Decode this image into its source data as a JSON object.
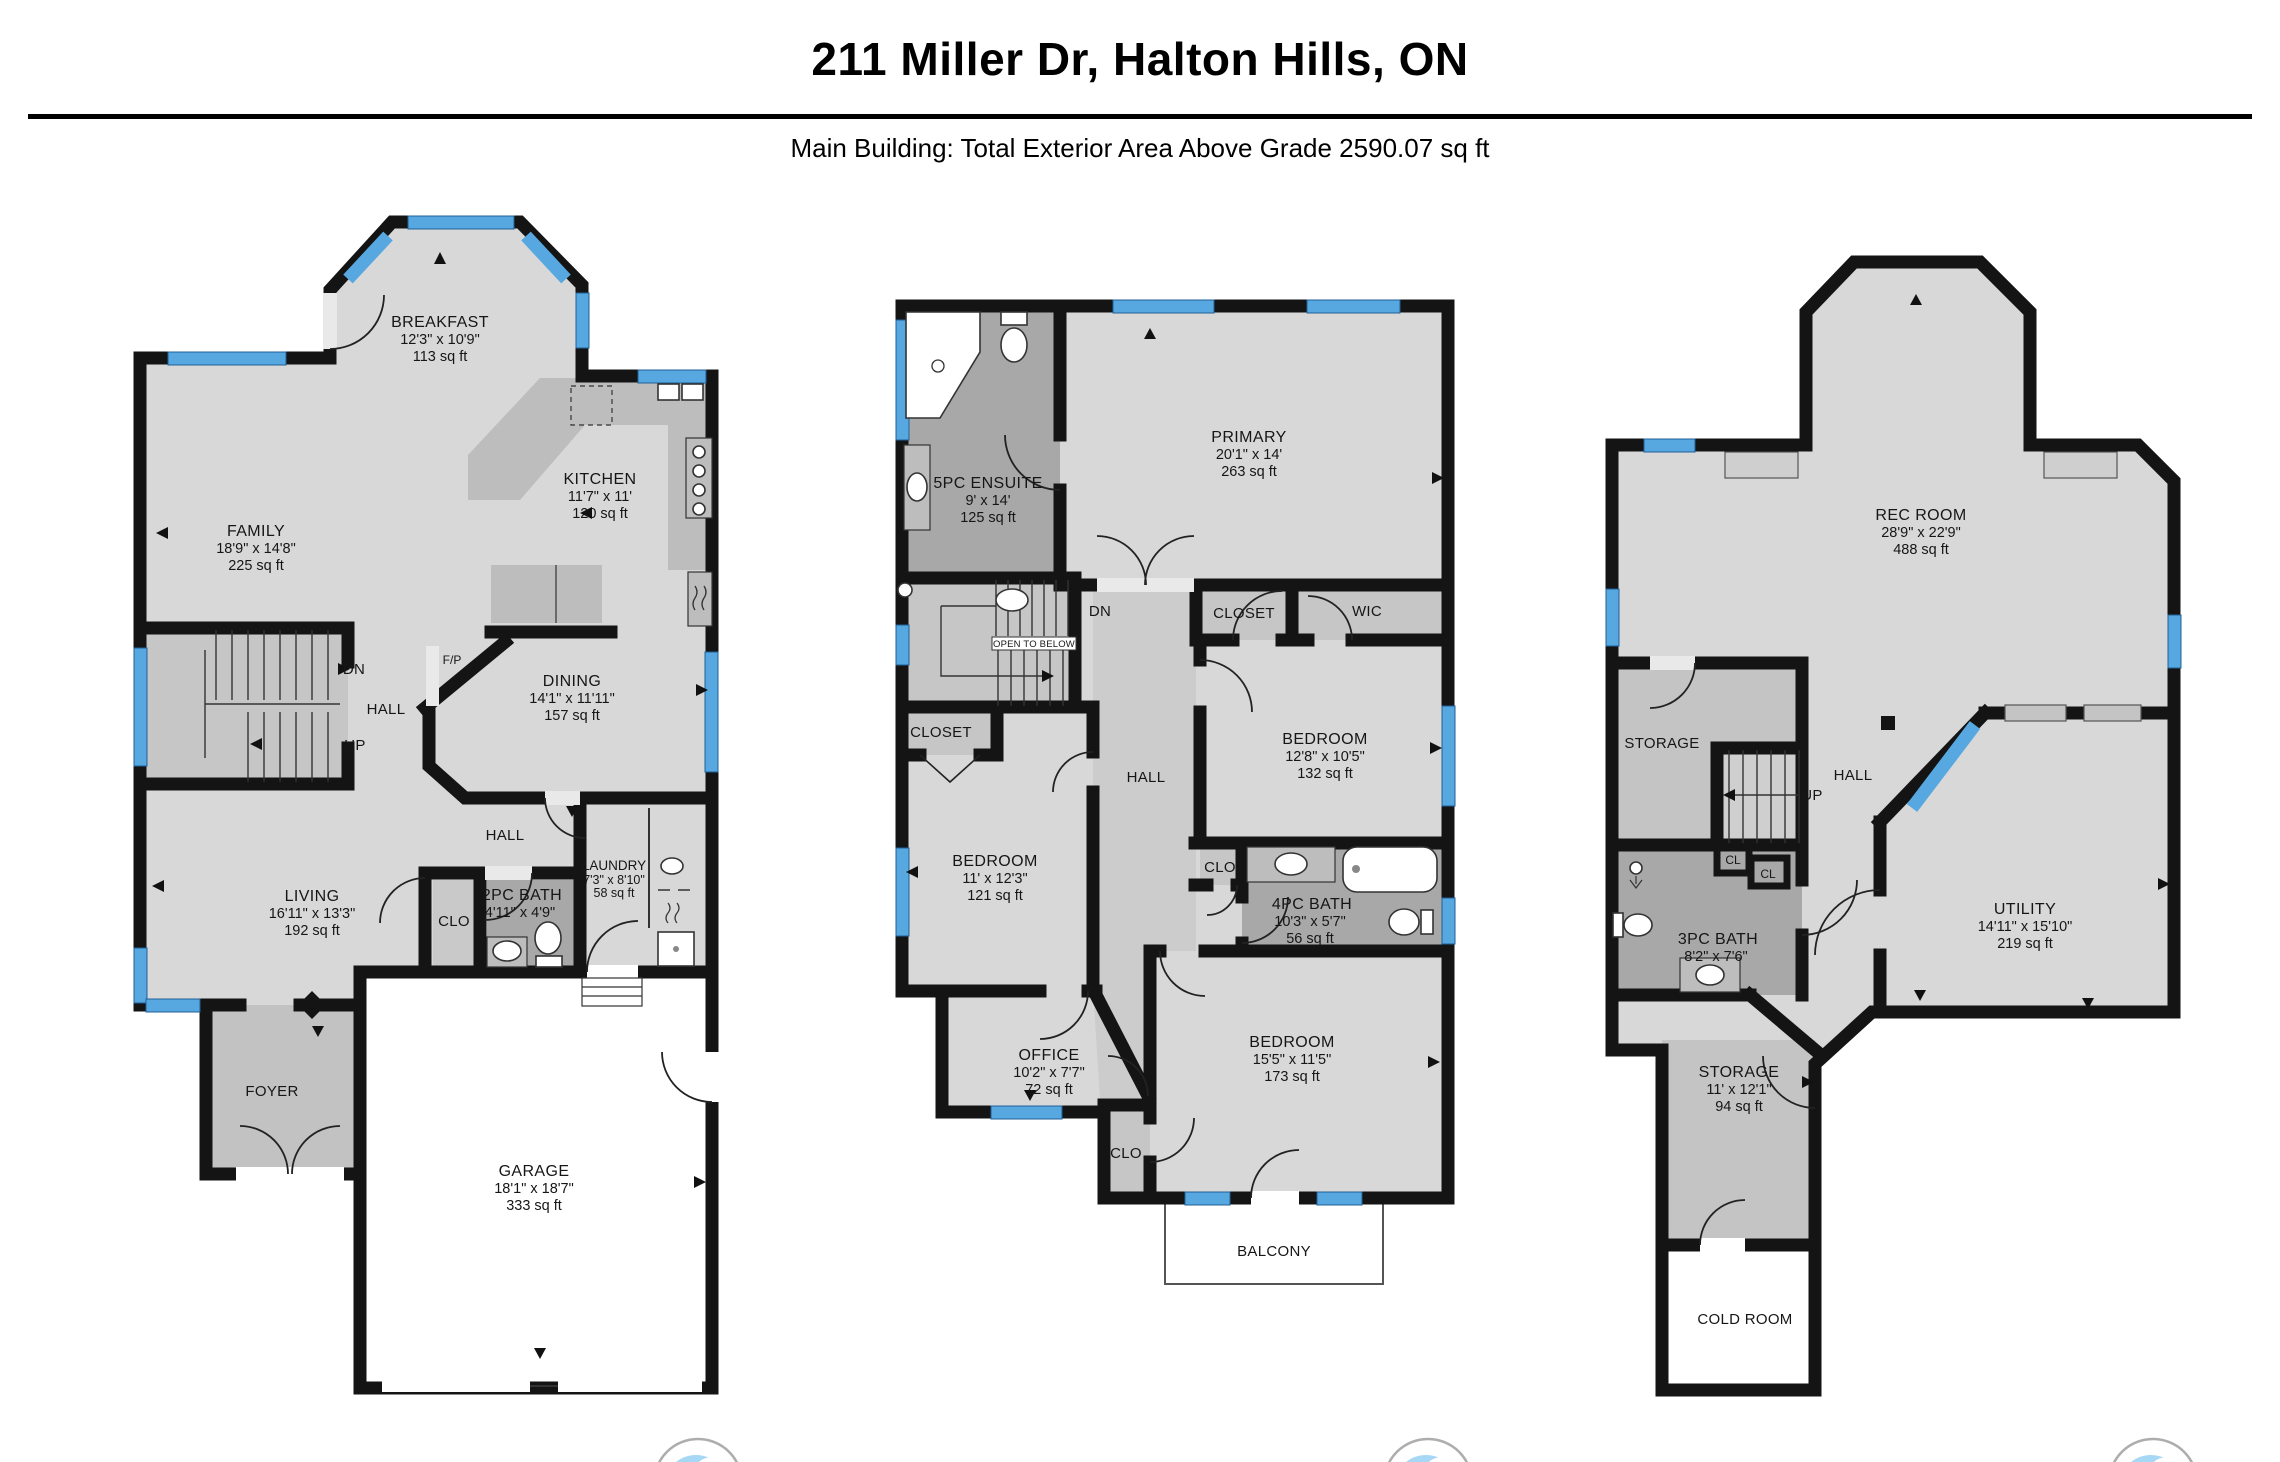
{
  "header": {
    "title": "211 Miller Dr, Halton Hills, ON",
    "subtitle": "Main Building: Total Exterior Area Above Grade 2590.07 sq ft"
  },
  "colors": {
    "wall": "#141414",
    "window_blue": "#57a8e0",
    "floor_light": "#d8d8d8",
    "floor_medium": "#c6c6c6",
    "floor_dark": "#a8a8a8"
  },
  "plans": [
    {
      "rooms": [
        {
          "name": "BREAKFAST",
          "dims": "12'3\" x 10'9\"",
          "area": "113 sq ft"
        },
        {
          "name": "FAMILY",
          "dims": "18'9\" x 14'8\"",
          "area": "225 sq ft"
        },
        {
          "name": "KITCHEN",
          "dims": "11'7\" x 11'",
          "area": "120 sq ft"
        },
        {
          "name": "F/P"
        },
        {
          "name": "DN"
        },
        {
          "name": "HALL"
        },
        {
          "name": "UP"
        },
        {
          "name": "DINING",
          "dims": "14'1\" x 11'11\"",
          "area": "157 sq ft"
        },
        {
          "name": "LIVING",
          "dims": "16'11\" x 13'3\"",
          "area": "192 sq ft"
        },
        {
          "name": "HALL"
        },
        {
          "name": "CLO"
        },
        {
          "name": "2PC BATH",
          "dims": "4'11\" x 4'9\""
        },
        {
          "name": "LAUNDRY",
          "dims": "7'3\" x 8'10\"",
          "area": "58 sq ft"
        },
        {
          "name": "FOYER"
        },
        {
          "name": "GARAGE",
          "dims": "18'1\" x 18'7\"",
          "area": "333 sq ft"
        }
      ]
    },
    {
      "rooms": [
        {
          "name": "5PC ENSUITE",
          "dims": "9' x 14'",
          "area": "125 sq ft"
        },
        {
          "name": "PRIMARY",
          "dims": "20'1\" x 14'",
          "area": "263 sq ft"
        },
        {
          "name": "DN"
        },
        {
          "name": "OPEN TO BELOW"
        },
        {
          "name": "CLOSET"
        },
        {
          "name": "WIC"
        },
        {
          "name": "BEDROOM",
          "dims": "12'8\" x 10'5\"",
          "area": "132 sq ft"
        },
        {
          "name": "CLOSET"
        },
        {
          "name": "HALL"
        },
        {
          "name": "BEDROOM",
          "dims": "11' x 12'3\"",
          "area": "121 sq ft"
        },
        {
          "name": "CLO"
        },
        {
          "name": "4PC BATH",
          "dims": "10'3\" x 5'7\"",
          "area": "56 sq ft"
        },
        {
          "name": "OFFICE",
          "dims": "10'2\" x 7'7\"",
          "area": "72 sq ft"
        },
        {
          "name": "BEDROOM",
          "dims": "15'5\" x 11'5\"",
          "area": "173 sq ft"
        },
        {
          "name": "CLO"
        },
        {
          "name": "BALCONY"
        }
      ]
    },
    {
      "rooms": [
        {
          "name": "REC ROOM",
          "dims": "28'9\" x 22'9\"",
          "area": "488 sq ft"
        },
        {
          "name": "STORAGE"
        },
        {
          "name": "UP"
        },
        {
          "name": "HALL"
        },
        {
          "name": "CL"
        },
        {
          "name": "CL"
        },
        {
          "name": "3PC BATH",
          "dims": "8'2\" x 7'6\""
        },
        {
          "name": "UTILITY",
          "dims": "14'11\" x 15'10\"",
          "area": "219 sq ft"
        },
        {
          "name": "STORAGE",
          "dims": "11' x 12'1\"",
          "area": "94 sq ft"
        },
        {
          "name": "COLD ROOM"
        }
      ]
    }
  ]
}
